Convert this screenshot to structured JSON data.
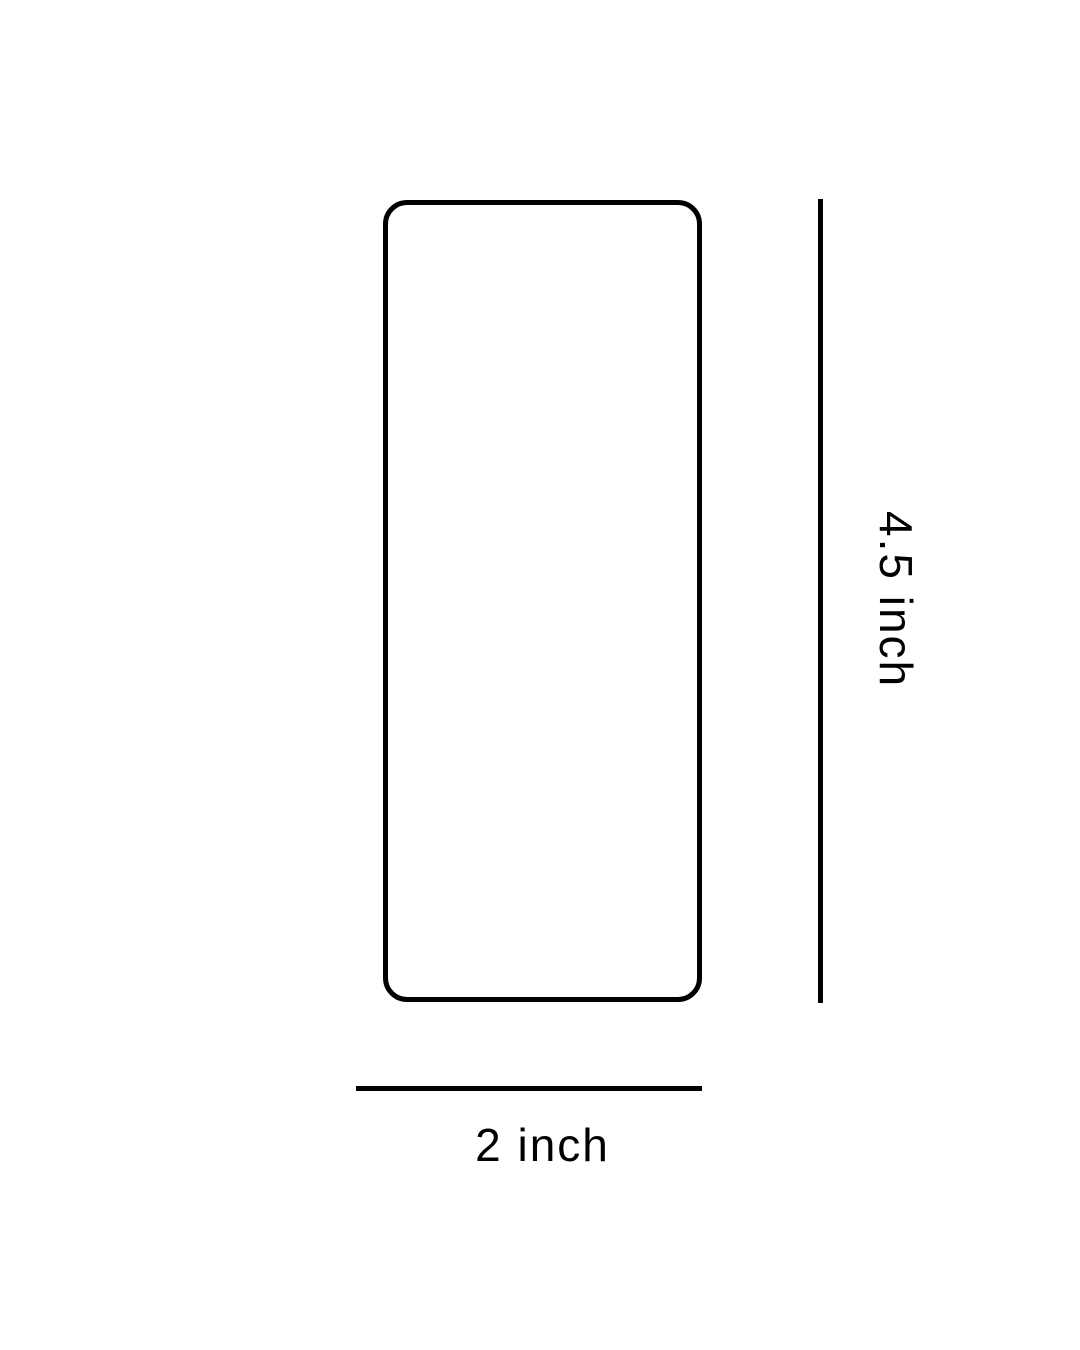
{
  "diagram": {
    "title": "label-size-diagram",
    "shape": {
      "name": "rounded-rectangle-label-outline"
    },
    "dimensions": {
      "height": {
        "label": "4.5 inch"
      },
      "width": {
        "label": "2 inch"
      }
    },
    "colors": {
      "background": "#ffffff",
      "line": "#000000",
      "text": "#000000"
    }
  }
}
